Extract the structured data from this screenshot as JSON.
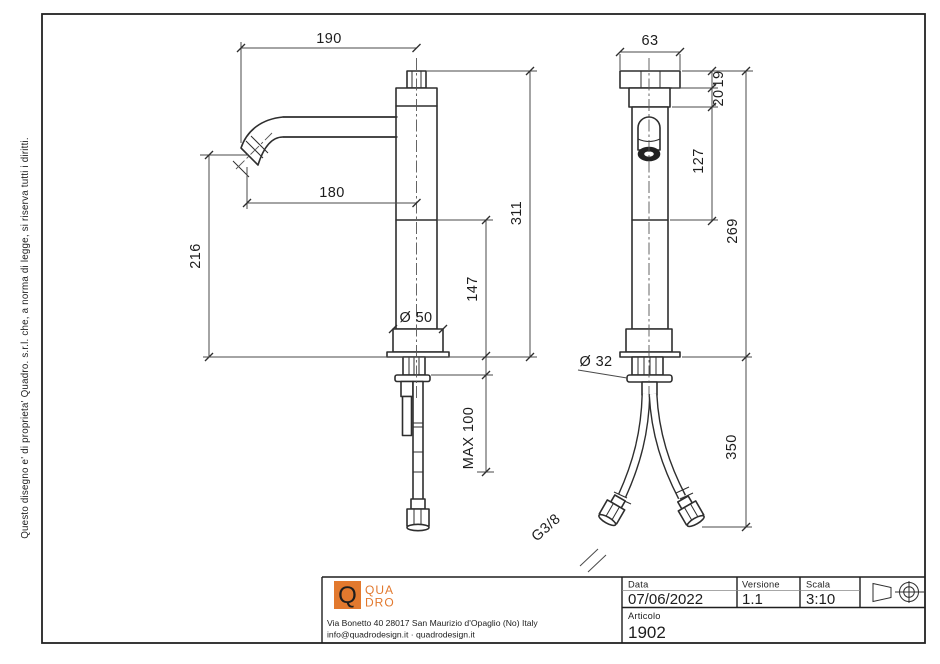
{
  "drawing": {
    "copyright": "Questo disegno e' di proprieta' Quadro. s.r.l. che, a norma di legge, si riserva tutti i diritti.",
    "dims": {
      "d190": "190",
      "d180": "180",
      "d216": "216",
      "d311": "311",
      "d147": "147",
      "dmax": "MAX 100",
      "d50": "Ø 50",
      "d63": "63",
      "d19": "19",
      "d20": "20",
      "d127": "127",
      "d269": "269",
      "d350": "350",
      "d32": "Ø 32",
      "thread": "G3/8"
    }
  },
  "title_block": {
    "logo_q": "Q",
    "logo_top": "QUA",
    "logo_bottom": "DRO",
    "address": "Via Bonetto 40  28017 San Maurizio d'Opaglio (No) Italy",
    "contacts": "info@quadrodesign.it  ·  quadrodesign.it",
    "data_label": "Data",
    "data_value": "07/06/2022",
    "versione_label": "Versione",
    "versione_value": "1.1",
    "scala_label": "Scala",
    "scala_value": "3:10",
    "articolo_label": "Articolo",
    "articolo_value": "1902"
  },
  "colors": {
    "accent": "#E2792E",
    "line": "#2e2e2e"
  }
}
